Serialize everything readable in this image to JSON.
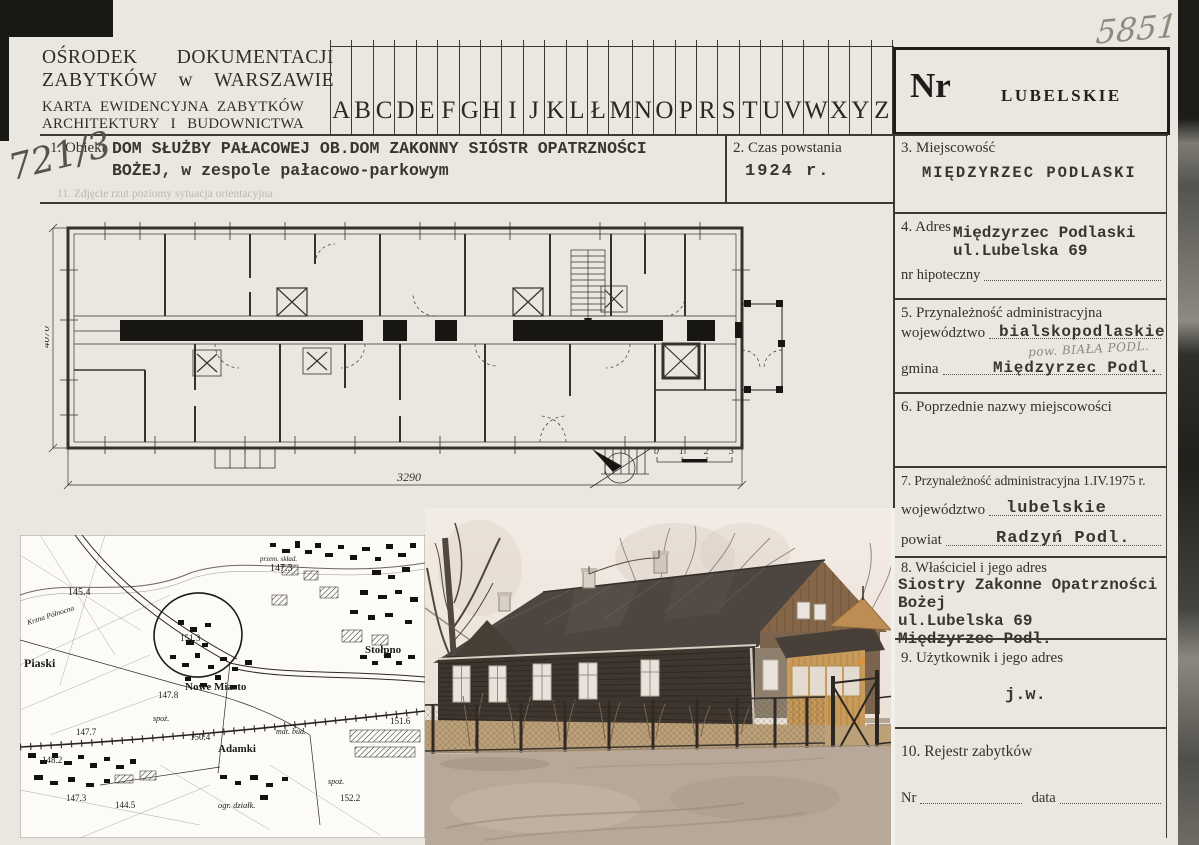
{
  "header": {
    "org_line1": "OŚRODEK DOKUMENTACJI",
    "org_line2": "ZABYTKÓW w WARSZAWIE",
    "card_line1": "KARTA EWIDENCYJNA ZABYTKÓW",
    "card_line2": "ARCHITEKTURY I BUDOWNICTWA",
    "alphabet": [
      "A",
      "B",
      "C",
      "D",
      "E",
      "F",
      "G",
      "H",
      "I",
      "J",
      "K",
      "L",
      "Ł",
      "M",
      "N",
      "O",
      "P",
      "R",
      "S",
      "T",
      "U",
      "V",
      "W",
      "X",
      "Y",
      "Z"
    ],
    "nr_label": "Nr",
    "voivodeship_stamp": "LUBELSKIE",
    "handwritten_number": "5851"
  },
  "annotations": {
    "inventory_number": "721/3",
    "pencil_note": "pow. BIAŁA PODL."
  },
  "sections": {
    "s1": {
      "label": "1. Obiekt",
      "value_line1": "DOM SŁUŻBY PAŁACOWEJ OB.DOM ZAKONNY SIÓSTR OPATRZNOŚCI",
      "value_line2": "BOŻEJ, w zespole pałacowo-parkowym"
    },
    "s2": {
      "label": "2. Czas powstania",
      "value": "1924 r."
    },
    "s3": {
      "label": "3. Miejscowość",
      "value": "MIĘDZYRZEC PODLASKI"
    },
    "s4": {
      "label": "4. Adres",
      "value_line1": "Międzyrzec Podlaski",
      "value_line2": "ul.Lubelska 69",
      "sub_label": "nr hipoteczny"
    },
    "s5": {
      "label": "5. Przynależność administracyjna",
      "field1": "województwo",
      "value1": "bialskopodlaskie",
      "field2": "gmina",
      "value2": "Międzyrzec Podl."
    },
    "s6": {
      "label": "6. Poprzednie nazwy miejscowości"
    },
    "s7": {
      "label": "7. Przynależność administracyjna 1.IV.1975 r.",
      "field1": "województwo",
      "value1": "lubelskie",
      "field2": "powiat",
      "value2": "Radzyń Podl."
    },
    "s8": {
      "label": "8. Właściciel i jego adres",
      "lines": [
        "Siostry Zakonne Opatrzności",
        "Bożej",
        "ul.Lubelska 69",
        "Międzyrzec Podl."
      ]
    },
    "s9": {
      "label": "9. Użytkownik i jego adres",
      "value": "j.w."
    },
    "s10": {
      "label": "10. Rejestr zabytków",
      "field1": "Nr",
      "field2": "data"
    },
    "s11": {
      "label": "11. Zdjęcie rzut poziomy sytuacja orientacyjna"
    }
  },
  "plan": {
    "dim_left": "4070",
    "dim_bottom": "3290",
    "scale": [
      "0",
      "1",
      "2",
      "3"
    ]
  },
  "map": {
    "labels": [
      "145.4",
      "147.3",
      "Piaski",
      "Stołpno",
      "Nowe Miasto",
      "151.3",
      "147.8",
      "147.7",
      "spoż.",
      "150.4",
      "Adamki",
      "mat. bud.",
      "148.2",
      "147.3",
      "144.5",
      "ogr. działk.",
      "152.2",
      "151.6",
      "spoż.",
      "Krzna Północna",
      "przem. skład."
    ]
  },
  "colors": {
    "card_bg": "#eae7e0",
    "ink": "#3c3934",
    "typed_ink": "#3a362f",
    "pencil": "#8f877a",
    "photo_wall": "#352f29",
    "photo_porch": "#c79a58"
  }
}
